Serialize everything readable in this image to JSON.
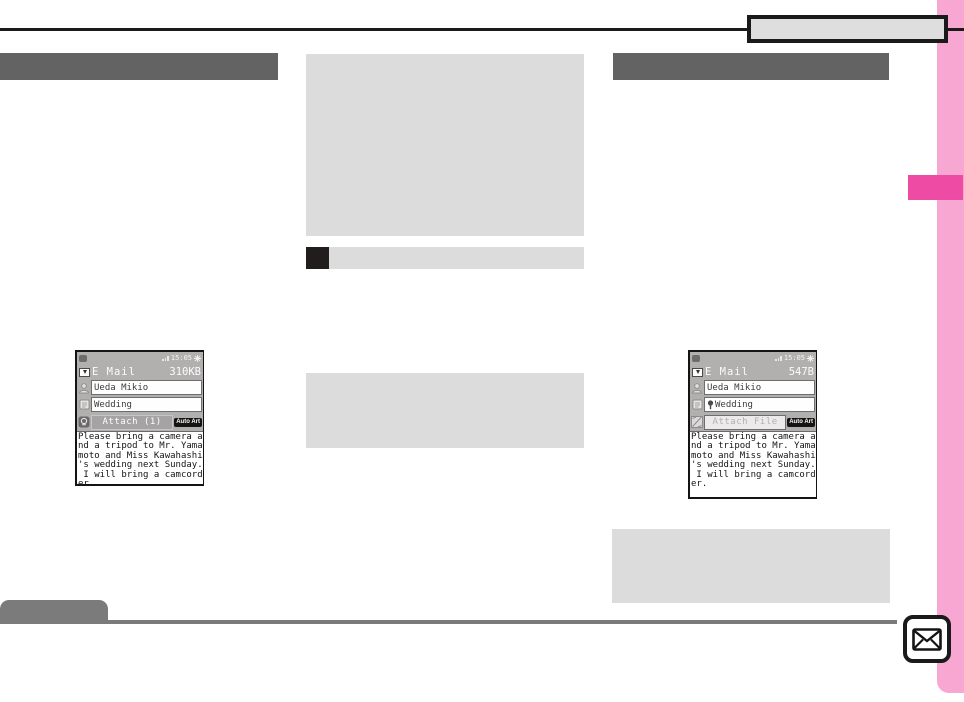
{
  "colors": {
    "accent_pink_light": "#F7A7D2",
    "accent_pink_dark": "#EE4BA4",
    "header_bar_gray": "#636363",
    "panel_gray": "#DCDCDC",
    "footer_gray": "#7B7B7B",
    "rule_black": "#1A1A1A"
  },
  "icons": {
    "bottom_right": "envelope-icon"
  },
  "screens": {
    "left": {
      "time": "15:05",
      "title": "E Mail",
      "size": "310KB",
      "to": "Ueda Mikio",
      "subject": "Wedding",
      "attach": "Attach (1)",
      "auto_art": "Auto Art",
      "body_lines": [
        "Please bring a camera a",
        "nd a tripod to Mr. Yama",
        "moto and Miss Kawahashi",
        "'s wedding next Sunday.",
        " I will bring a camcord",
        "er."
      ]
    },
    "right": {
      "time": "15:05",
      "title": "E Mail",
      "size": "547B",
      "to": "Ueda Mikio",
      "subject": "Wedding",
      "attach": "Attach File",
      "auto_art": "Auto Art",
      "body_lines": [
        "Please bring a camera a",
        "nd a tripod to Mr. Yama",
        "moto and Miss Kawahashi",
        "'s wedding next Sunday.",
        " I will bring a camcord",
        "er."
      ]
    }
  }
}
